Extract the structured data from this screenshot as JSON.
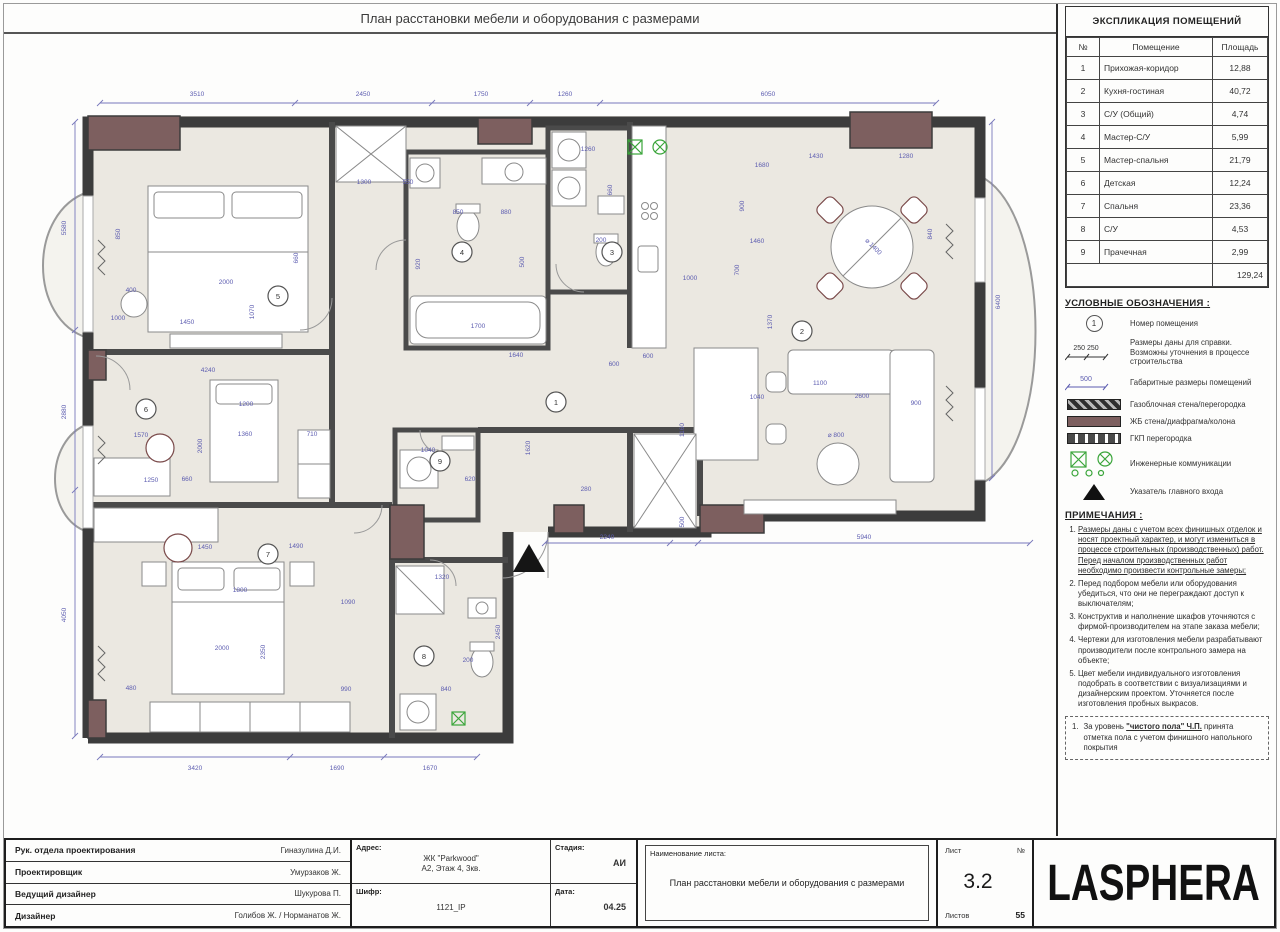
{
  "title": "План расстановки мебели и оборудования с размерами",
  "colors": {
    "dimension_accent": "#5c5cb0",
    "wall": "#3c3c3c",
    "concrete_column": "#7d5f5f",
    "floor": "#ebe8e1",
    "engineering_green": "#3aa53a"
  },
  "explication": {
    "header": "ЭКСПЛИКАЦИЯ ПОМЕЩЕНИЙ",
    "columns": [
      "№",
      "Помещение",
      "Площадь"
    ],
    "rows": [
      [
        "1",
        "Прихожая-коридор",
        "12,88"
      ],
      [
        "2",
        "Кухня-гостиная",
        "40,72"
      ],
      [
        "3",
        "С/У (Общий)",
        "4,74"
      ],
      [
        "4",
        "Мастер-С/У",
        "5,99"
      ],
      [
        "5",
        "Мастер-спальня",
        "21,79"
      ],
      [
        "6",
        "Детская",
        "12,24"
      ],
      [
        "7",
        "Спальня",
        "23,36"
      ],
      [
        "8",
        "С/У",
        "4,53"
      ],
      [
        "9",
        "Прачечная",
        "2,99"
      ]
    ],
    "total": "129,24"
  },
  "legend": {
    "header": "УСЛОВНЫЕ ОБОЗНАЧЕНИЯ :",
    "room_number_symbol": "1",
    "dims_ref_values": "250 250",
    "dims_overall_value": "500",
    "items": [
      "Номер помещения",
      "Размеры даны для справки. Возможны уточнения в процессе строительства",
      "Габаритные размеры помещений",
      "Газоблочная стена/перегородка",
      "ЖБ стена/диафрагма/колона",
      "ГКП перегородка",
      "Инженерные коммуникации",
      "Указатель главного входа"
    ]
  },
  "notes": {
    "header": "ПРИМЕЧАНИЯ :",
    "items": [
      "Размеры даны с учетом всех финишных отделок и носят проектный характер, и могут измениться в процессе строительных (производственных) работ. Перед началом производственных работ необходимо произвести контрольные замеры;",
      "Перед подбором мебели или оборудования убедиться, что они не переграждают доступ к выключателям;",
      "Конструктив и наполнение шкафов уточняются с фирмой-производителем на этапе заказа мебели;",
      "Чертежи для изготовления мебели разрабатывают производители после контрольного замера на объекте;",
      "Цвет мебели индивидуального изготовления подобрать в соответствии с визуализациями и дизайнерским проектом. Уточняется после изготовления пробных выкрасов."
    ],
    "box_no": "1.",
    "box_pre": "За уровень ",
    "box_key": "\"чистого пола\" Ч.П.",
    "box_post": " принята отметка пола с учетом финишного напольного покрытия"
  },
  "titleblock": {
    "rows": [
      {
        "label": "Рук. отдела проектирования",
        "value": "Гиназулина Д.И."
      },
      {
        "label": "Проектировщик",
        "value": "Умурзаков Ж."
      },
      {
        "label": "Ведущий дизайнер",
        "value": "Шукурова П."
      },
      {
        "label": "Дизайнер",
        "value": "Голибов Ж. / Норманатов Ж."
      }
    ],
    "address_label": "Адрес:",
    "address_line1": "ЖК \"Parkwood\"",
    "address_line2": "А2, Этаж 4, 3кв.",
    "cipher_label": "Шифр:",
    "cipher": "1121_IP",
    "stage_label": "Стадия:",
    "stage": "АИ",
    "date_label": "Дата:",
    "date": "04.25",
    "sheet_name_label": "Наименование листа:",
    "sheet_name": "План расстановки  мебели и оборудования  с размерами",
    "sheet_label": "Лист",
    "number_label": "№",
    "sheet_number": "3.2",
    "sheets_label": "Листов",
    "sheets_total": "55",
    "logo": "LASPHERA"
  },
  "plan": {
    "room_markers": [
      [
        "1",
        556,
        402
      ],
      [
        "2",
        802,
        331
      ],
      [
        "3",
        612,
        252
      ],
      [
        "4",
        462,
        252
      ],
      [
        "5",
        278,
        296
      ],
      [
        "6",
        146,
        409
      ],
      [
        "7",
        268,
        554
      ],
      [
        "8",
        424,
        656
      ],
      [
        "9",
        440,
        461
      ]
    ],
    "dim_labels": [
      [
        "3510",
        197,
        96
      ],
      [
        "2450",
        363,
        96
      ],
      [
        "1750",
        481,
        96
      ],
      [
        "1260",
        565,
        96
      ],
      [
        "6050",
        768,
        96
      ],
      [
        "5580",
        66,
        228,
        -90
      ],
      [
        "2880",
        66,
        412,
        -90
      ],
      [
        "4050",
        66,
        615,
        -90
      ],
      [
        "6400",
        1000,
        302,
        -90
      ],
      [
        "2240",
        607,
        539
      ],
      [
        "500",
        684,
        522,
        -90
      ],
      [
        "5940",
        864,
        539
      ],
      [
        "3420",
        195,
        770
      ],
      [
        "1690",
        337,
        770
      ],
      [
        "1670",
        430,
        770
      ],
      [
        "850",
        120,
        234,
        -90
      ],
      [
        "2000",
        226,
        284
      ],
      [
        "1450",
        187,
        324
      ],
      [
        "1000",
        118,
        320
      ],
      [
        "1070",
        254,
        312,
        -90
      ],
      [
        "400",
        131,
        292
      ],
      [
        "660",
        298,
        258,
        -90
      ],
      [
        "1300",
        364,
        184
      ],
      [
        "550",
        408,
        184
      ],
      [
        "850",
        458,
        214
      ],
      [
        "880",
        506,
        214
      ],
      [
        "920",
        420,
        264,
        -90
      ],
      [
        "1700",
        478,
        328
      ],
      [
        "500",
        524,
        262,
        -90
      ],
      [
        "1260",
        588,
        151
      ],
      [
        "660",
        612,
        190,
        -90
      ],
      [
        "200",
        601,
        242
      ],
      [
        "1680",
        762,
        167
      ],
      [
        "1430",
        816,
        158
      ],
      [
        "1280",
        906,
        158
      ],
      [
        "900",
        744,
        206,
        -90
      ],
      [
        "840",
        932,
        234,
        -90
      ],
      [
        "1000",
        690,
        280
      ],
      [
        "700",
        739,
        270,
        -90
      ],
      [
        "1460",
        757,
        243
      ],
      [
        "600",
        648,
        358
      ],
      [
        "⌀ 1400",
        872,
        248,
        45
      ],
      [
        "900",
        916,
        405
      ],
      [
        "1370",
        772,
        322,
        -90
      ],
      [
        "2600",
        862,
        398
      ],
      [
        "1100",
        820,
        385
      ],
      [
        "1040",
        757,
        399
      ],
      [
        "⌀ 800",
        836,
        437
      ],
      [
        "1640",
        516,
        357
      ],
      [
        "1620",
        530,
        448,
        -90
      ],
      [
        "280",
        586,
        491
      ],
      [
        "600",
        614,
        366
      ],
      [
        "1160",
        684,
        430,
        -90
      ],
      [
        "1040",
        428,
        452
      ],
      [
        "620",
        470,
        481
      ],
      [
        "4240",
        208,
        372
      ],
      [
        "1200",
        246,
        406
      ],
      [
        "1360",
        245,
        436
      ],
      [
        "710",
        312,
        436
      ],
      [
        "1570",
        141,
        437
      ],
      [
        "1250",
        151,
        482
      ],
      [
        "660",
        187,
        481
      ],
      [
        "2000",
        202,
        446,
        -90
      ],
      [
        "1450",
        205,
        549
      ],
      [
        "1490",
        296,
        548
      ],
      [
        "1800",
        240,
        592
      ],
      [
        "2000",
        222,
        650
      ],
      [
        "2350",
        265,
        652,
        -90
      ],
      [
        "1090",
        348,
        604
      ],
      [
        "990",
        346,
        691
      ],
      [
        "840",
        446,
        691
      ],
      [
        "480",
        131,
        690
      ],
      [
        "1320",
        442,
        579
      ],
      [
        "200",
        468,
        662
      ],
      [
        "2450",
        500,
        632,
        -90
      ]
    ]
  }
}
